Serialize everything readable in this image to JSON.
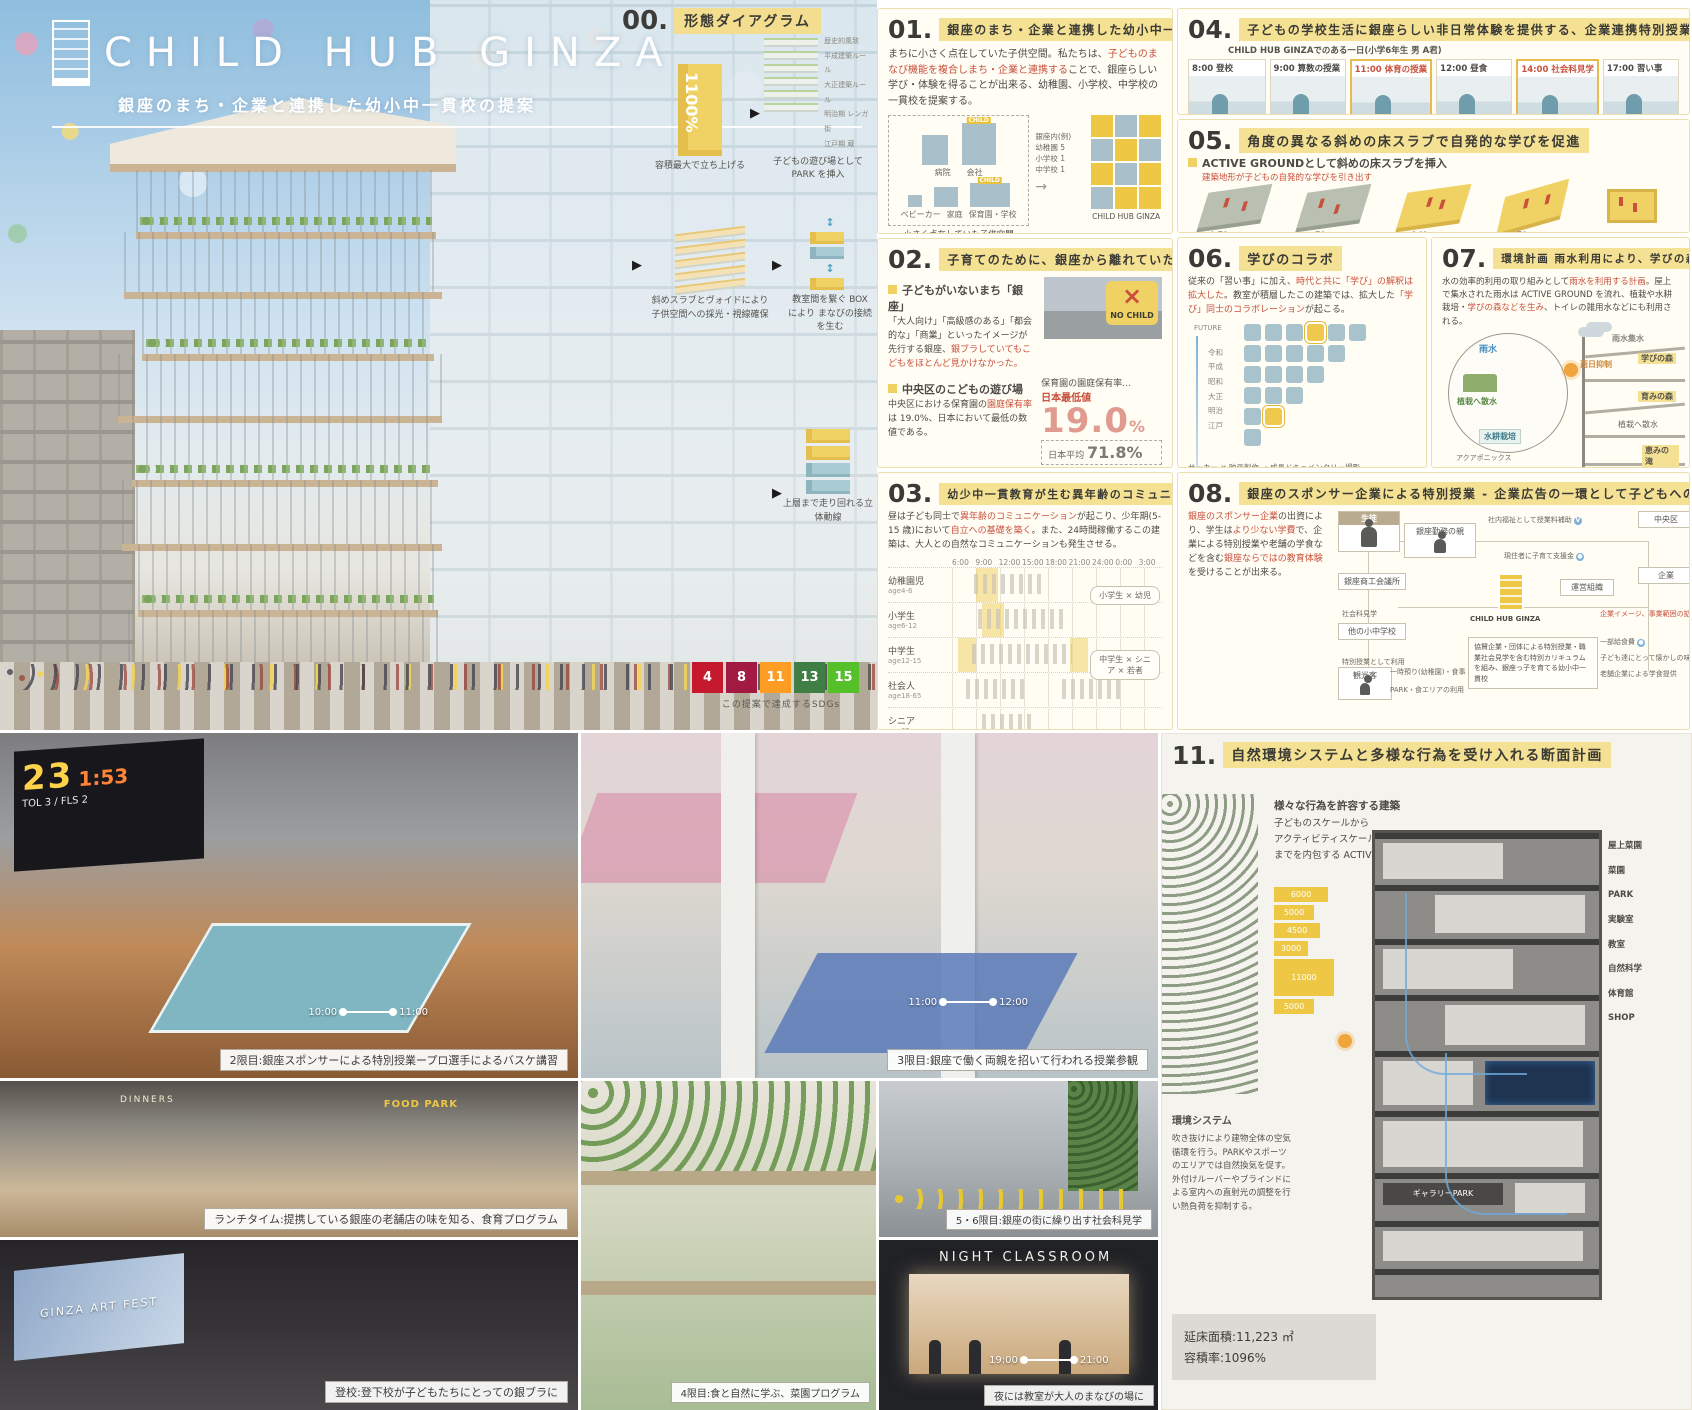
{
  "poster": {
    "title": "CHILD HUB GINZA",
    "subtitle": "銀座のまち・企業と連携した幼小中一貫校の提案"
  },
  "sdgs": {
    "caption": "この提案で達成するSDGs",
    "goals": [
      {
        "n": "4",
        "c": "#C5192D"
      },
      {
        "n": "8",
        "c": "#A21942"
      },
      {
        "n": "11",
        "c": "#FD9D24"
      },
      {
        "n": "13",
        "c": "#3F7E44"
      },
      {
        "n": "15",
        "c": "#56C02B"
      }
    ]
  },
  "s00": {
    "num": "00.",
    "title": "形態ダイアグラム",
    "steps": [
      {
        "tag": "1100%",
        "caption": "容積最大で立ち上げる"
      },
      {
        "caption": "子どもの遊び場として PARK を挿入",
        "labels": [
          "歴史的風致",
          "平成建築ルール",
          "大正建築ルール",
          "明治期 レンガ街",
          "江戸期 蔵"
        ]
      },
      {
        "caption": "斜めスラブとヴォイドにより 子供空間への採光・視線確保"
      },
      {
        "caption": "教室間を繋ぐ BOX により まなびの接続を生む"
      },
      {
        "caption": "上層まで走り回れる立体動線"
      }
    ]
  },
  "s01": {
    "num": "01.",
    "title": "銀座のまち・企業と連携した幼小中一貫校へ",
    "body1": "まちに小さく点在していた子供空間。私たちは、",
    "body2": "子どものまなび機能を複合しまち・企業と連携する",
    "body3": "ことで、銀座らしい学び・体験を得ることが出来る、幼稚園、小学校、中学校の一貫校を提案する。",
    "diagram": {
      "items": [
        "病院",
        "会社",
        "ベビーカー",
        "家庭",
        "保育園・学校"
      ],
      "note": [
        "銀座内(例)",
        "幼稚園 5",
        "小学校 1",
        "中学校 1"
      ],
      "caption": "小さく点在していた子供空間",
      "child_sign": "CHILD",
      "result": "CHILD HUB GINZA"
    }
  },
  "s02": {
    "num": "02.",
    "title": "子育てのために、銀座から離れていた人々",
    "sub1": "子どもがいないまち「銀座」",
    "p1a": "「大人向け」「高級感のある」「都会的な」「商業」といったイメージが先行する銀座、",
    "p1b": "銀ブラしていてもこどもをほとんど見かけなかった。",
    "nochild": "NO CHILD",
    "sub2": "中央区のこどもの遊び場",
    "p2a": "中央区における保育園の",
    "p2b": "園庭保有率",
    "p2c": "は 19.0%、日本において最低の数値である。",
    "stat_title": "保育園の園庭保有率…",
    "stat_label": "日本最低値",
    "stat_value": "19.0",
    "stat_unit": "%",
    "avg_label": "日本平均",
    "avg_value": "71.8%",
    "sub3": "お母さんは働けない?",
    "p3": "女性の有業率は子育て世代である30代で減少し出産以前から働いていた人の約半数が退職する。",
    "chart_label": "女性の有業率",
    "chart_start": "81.2%",
    "chart_note": "減少",
    "chart_end": "72.9%",
    "pie_value": "48.9%",
    "pie_label1": "半数が",
    "pie_label2": "出産退職"
  },
  "s03": {
    "num": "03.",
    "title": "幼少中一貫教育が生む異年齢のコミュニケーション",
    "pa": "昼は子ども同士で",
    "pb": "異年齢のコミュニケーション",
    "pc": "が起こり、少年期(5-15 歳)において",
    "pd": "自立への基礎を築く",
    "pe": "。また、24時間稼働するこの建築は、大人との自然なコミュニケーションも発生させる。",
    "times": [
      "6:00",
      "9:00",
      "12:00",
      "15:00",
      "18:00",
      "21:00",
      "24:00",
      "0:00",
      "3:00"
    ],
    "rows": [
      {
        "name": "幼稚園児",
        "age": "age4-6"
      },
      {
        "name": "小学生",
        "age": "age6-12"
      },
      {
        "name": "中学生",
        "age": "age12-15"
      },
      {
        "name": "社会人",
        "age": "age18-65"
      },
      {
        "name": "シニア",
        "age": "age65-"
      }
    ],
    "callouts": [
      "小学生 × 幼児",
      "中学生 × シニア × 若者"
    ],
    "footer": "24 時間割表"
  },
  "s04": {
    "num": "04.",
    "title": "子どもの学校生活に銀座らしい非日常体験を提供する、企業連携特別授業",
    "sub": "CHILD HUB GINZAでのある一日(小学6年生 男 A君)",
    "items": [
      {
        "time": "8:00 登校",
        "cap": "登校中のギャラリー通り"
      },
      {
        "time": "9:00 算数の授業",
        "cap": "通常授業"
      },
      {
        "time": "11:00 体育の授業",
        "cap": "NBA選手とバスケ"
      },
      {
        "time": "12:00 昼食",
        "cap": "老舗の逸品料理"
      },
      {
        "time": "14:00 社会科見学",
        "cap": "商品開発の見学"
      },
      {
        "time": "17:00 習い事",
        "cap": "習い事を楽しむ"
      }
    ]
  },
  "s05": {
    "num": "05.",
    "title": "角度の異なる斜めの床スラブで自発的な学びを促進",
    "sub": "ACTIVE GROUNDとして斜めの床スラブを挿入",
    "note": "建築地形が子どもの自発的な学びを引き出す",
    "slopes": [
      {
        "angle": "4.7°",
        "grade": "1/12勾配",
        "cap": "考える"
      },
      {
        "angle": "7°",
        "grade": "1/8勾配",
        "cap": "感じる"
      },
      {
        "angle": "14°",
        "grade": "1/4勾配",
        "cap": "ひととはなす"
      },
      {
        "angle": "27°",
        "grade": "1/2勾配",
        "cap": "みる・工夫する"
      },
      {
        "angle": "",
        "grade": "",
        "cap": "協力する"
      }
    ]
  },
  "s06": {
    "num": "06.",
    "title": "学びのコラボ",
    "pa": "従来の「習い事」に加え、",
    "pb": "時代と共に「学び」の解釈は拡大した",
    "pc": "。教室が積層したこの建築では、拡大した",
    "pd": "「学び」同士のコラボレーション",
    "pe": "が起こる。",
    "future": "FUTURE",
    "past": "PAST",
    "eras": [
      "令和",
      "平成",
      "昭和",
      "大正",
      "明治",
      "江戸"
    ],
    "label": "学びのコラボ",
    "formula": "サッカー × 映画製作 → 成長ドキュメンタリー撮影"
  },
  "s07": {
    "num": "07.",
    "title": "環境計画 雨水利用により、学びの森が生まれる",
    "pa": "水の効率的利用の取り組みとして",
    "pb": "雨水を利用する計画",
    "pc": "。屋上で集水された雨水は ACTIVE GROUND を流れ、植栽や水耕栽培・",
    "pd": "学びの森などを生み",
    "pe": "、トイレの雑用水などにも利用される。",
    "labels": {
      "rain": "雨水",
      "spray": "植栽へ散水",
      "hydro": "水耕栽培",
      "aqua": "アクアポニックス",
      "collect": "雨水集水",
      "sun": "西日抑制",
      "forest1": "学びの森",
      "forest2": "育みの森",
      "spray2": "植栽へ散水",
      "fall": "恵みの滝"
    }
  },
  "s08": {
    "num": "08.",
    "title": "銀座のスポンサー企業による特別授業 - 企業広告の一環として子どもへの授業・投資",
    "pa": "銀座のスポンサー企業",
    "pb": "の出資により、学生は",
    "pc": "より少ない学費",
    "pd": "で、企業による特別授業や老舗の学食などを含む",
    "pe": "銀座ならではの教育体験",
    "pf": "を受けることが出来る。",
    "nodes": {
      "student": "生徒",
      "parent": "銀座勤務の親",
      "chamber": "銀座商工会議所",
      "ward": "中央区",
      "hub": "CHILD HUB GINZA",
      "org": "運営組織",
      "school": "他の小中学校",
      "tourist": "観光客",
      "company": "企業"
    },
    "notes": [
      "社内福祉として授業料補助",
      "現住者に子育て支援金",
      "特別授業として利用",
      "社会科見学",
      "一時預り(幼稚園)",
      "食事・スポンサー商品購入",
      "PARK・食エリアの利用",
      "一部給食費",
      "子ども達にとって懐かしの味に",
      "老舗企業による学食提供",
      "企業イメージ、事業範囲の拡大"
    ],
    "center_note": "協賛企業・団体による特別授業・職業社会見学を含む特別カリキュラムを組み、銀座っ子を育てる幼小中一貫校"
  },
  "s11": {
    "num": "11.",
    "title": "自然環境システムと多様な行為を受け入れる断面計画",
    "intro": [
      "様々な行為を許容する建築",
      "子どものスケールから",
      "アクティビティスケール",
      "までを内包する ACTIVE BOX"
    ],
    "dims": [
      "6000",
      "5000",
      "4500",
      "3000",
      "11000",
      "5000"
    ],
    "floor_labels": [
      "屋上菜園",
      "菜園",
      "PARK",
      "実験室",
      "教室",
      "自然科学",
      "体育館",
      "ギャラリーPARK",
      "SHOP"
    ],
    "env_title": "環境システム",
    "env_body": "吹き抜けにより建物全体の空気循環を行う。PARKやスポーツのエリアでは自然換気を促す。外付けルーバーやブラインドによる室内への直射光の調整を行い熱負荷を抑制する。",
    "stats": [
      {
        "label": "延床面積",
        "value": "11,223 ㎡"
      },
      {
        "label": "容積率",
        "value": "1096%"
      }
    ]
  },
  "photos": {
    "p1": {
      "caption": "2限目:銀座スポンサーによる特別授業ープロ選手によるバスケ講習",
      "t1": "10:00",
      "t2": "11:00",
      "scoreboard": {
        "score": "23",
        "time": "1:53",
        "l1": "TOL 3",
        "l2": "FLS 2"
      }
    },
    "p2": {
      "caption": "3限目:銀座で働く両親を招いて行われる授業参観",
      "t1": "11:00",
      "t2": "12:00"
    },
    "p3": {
      "caption": "ランチタイム:提携している銀座の老舗店の味を知る、食育プログラム",
      "sign": "DINNERS",
      "sign2": "FOOD PARK"
    },
    "p4": {
      "caption": "4限目:食と自然に学ぶ、菜園プログラム"
    },
    "p5": {
      "caption": "5・6限目:銀座の街に繰り出す社会科見学"
    },
    "p6": {
      "caption": "登校:登下校が子どもたちにとっての銀ブラに",
      "sign": "GINZA ART FEST"
    },
    "p7": {
      "caption": "夜には教室が大人のまなびの場に",
      "sign": "NIGHT CLASSROOM",
      "t1": "19:00",
      "t2": "21:00"
    }
  }
}
